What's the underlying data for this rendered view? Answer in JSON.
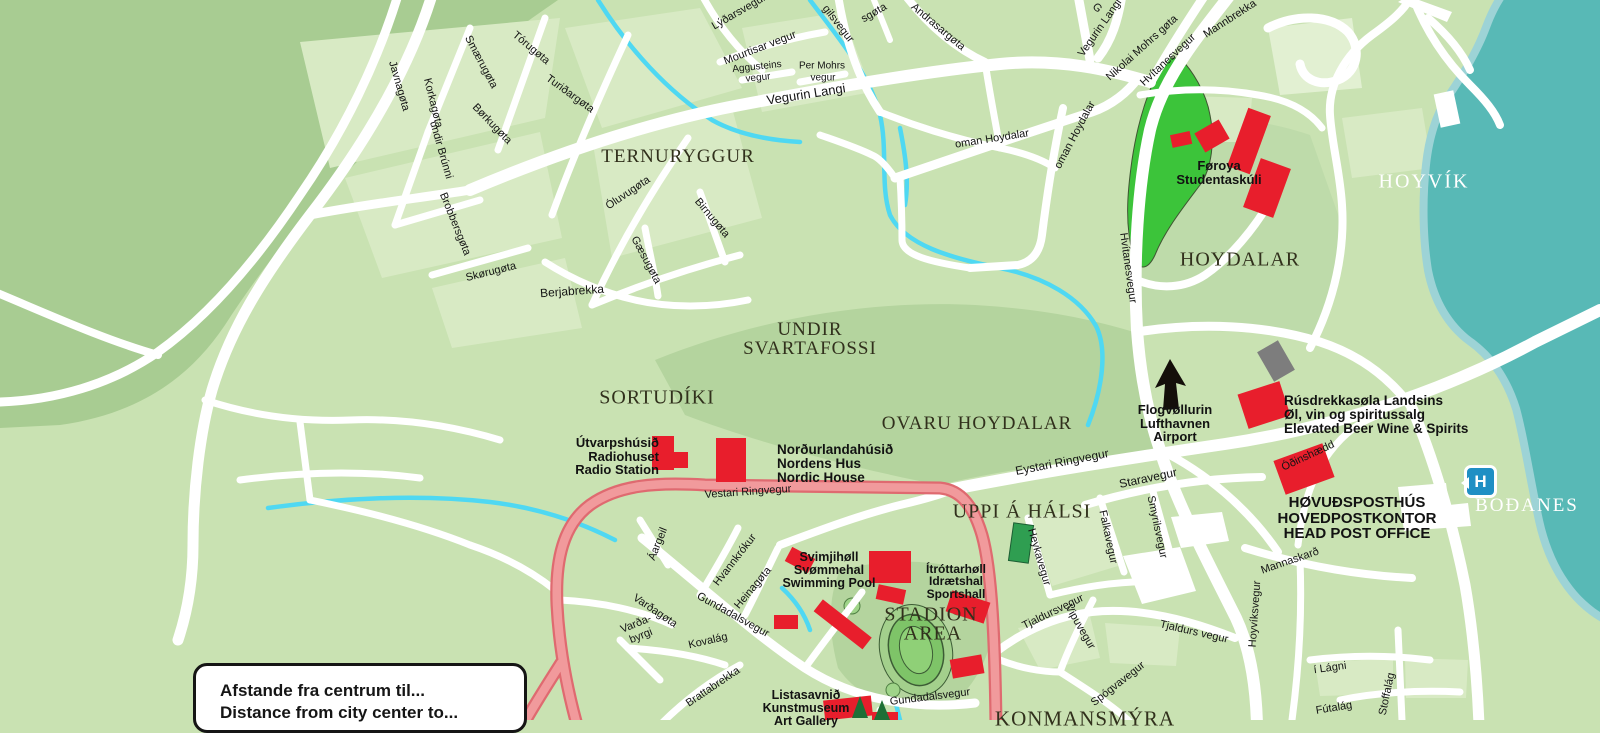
{
  "map": {
    "colors": {
      "land_base": "#c9e2b2",
      "land_light": "#d8eac4",
      "land_lighter": "#e2f0d2",
      "land_dark": "#a8cc92",
      "land_medium": "#b4d49e",
      "land_medium2": "#bedbaa",
      "park": "#3cc43a",
      "park_edge": "#3f5632",
      "water": "#58b9b6",
      "water_fringe": "#9dd3d6",
      "stream": "#4fd8f2",
      "road": "#ffffff",
      "ring_casing": "#df6a70",
      "ring_fill": "#f19a9c",
      "building_red": "#e81e2c",
      "building_gray": "#7d7d7d",
      "building_green": "#2f9e51",
      "track_blob": "#a3d08c",
      "track_green": "#7ec468",
      "track_line": "#3c5c35",
      "tree_dark": "#1e6f36",
      "arrow": "#140f0a",
      "hospital": "#1f8fc4"
    },
    "legend": {
      "line1": "Afstande fra centrum til...",
      "line2": "Distance from city center to..."
    },
    "hospital": {
      "letter": "H"
    },
    "street_labels": [
      {
        "text": "Javnagøta",
        "x": 399,
        "y": 86,
        "r": 74,
        "s": 11
      },
      {
        "text": "Korkagøta",
        "x": 433,
        "y": 103,
        "r": 76,
        "s": 11
      },
      {
        "text": "undir Brúnni",
        "x": 441,
        "y": 150,
        "r": 74,
        "s": 11
      },
      {
        "text": "Smærugøta",
        "x": 481,
        "y": 62,
        "r": 62,
        "s": 11
      },
      {
        "text": "Tórugøta",
        "x": 531,
        "y": 48,
        "r": 40,
        "s": 11
      },
      {
        "text": "Turiðargøta",
        "x": 570,
        "y": 94,
        "r": 36,
        "s": 11
      },
      {
        "text": "Børkugøta",
        "x": 492,
        "y": 124,
        "r": 46,
        "s": 11
      },
      {
        "text": "Brobbersgøta",
        "x": 455,
        "y": 224,
        "r": 68,
        "s": 11
      },
      {
        "text": "Skørugøta",
        "x": 491,
        "y": 272,
        "r": -14,
        "s": 11
      },
      {
        "text": "Berjabrekka",
        "x": 572,
        "y": 291,
        "r": -4,
        "s": 12
      },
      {
        "text": "Óluvugøta",
        "x": 628,
        "y": 193,
        "r": -34,
        "s": 11
      },
      {
        "text": "Gæsugøta",
        "x": 646,
        "y": 260,
        "r": 62,
        "s": 11
      },
      {
        "text": "Birnugøta",
        "x": 712,
        "y": 218,
        "r": 50,
        "s": 11
      },
      {
        "text": "Lýðarsvegur",
        "x": 739,
        "y": 12,
        "r": -30,
        "s": 11
      },
      {
        "text": "Mourtisar vegur",
        "x": 760,
        "y": 48,
        "r": -21,
        "s": 11
      },
      {
        "text": "Aggusteins",
        "x": 757,
        "y": 67,
        "r": -6,
        "s": 10
      },
      {
        "text": "vegur",
        "x": 758,
        "y": 78,
        "r": -6,
        "s": 10
      },
      {
        "text": "Per Mohrs",
        "x": 822,
        "y": 66,
        "r": 0,
        "s": 10
      },
      {
        "text": "vegur",
        "x": 823,
        "y": 78,
        "r": 0,
        "s": 10
      },
      {
        "text": "Vegurin Langi",
        "x": 806,
        "y": 94,
        "r": -9,
        "s": 13
      },
      {
        "text": "gilsvegur",
        "x": 838,
        "y": 24,
        "r": 52,
        "s": 11
      },
      {
        "text": "sgøta",
        "x": 874,
        "y": 13,
        "r": -30,
        "s": 11
      },
      {
        "text": "Andrasargøta",
        "x": 938,
        "y": 27,
        "r": 40,
        "s": 11
      },
      {
        "text": "oman Hoydalar",
        "x": 992,
        "y": 139,
        "r": -9,
        "s": 11
      },
      {
        "text": "oman Hoydalar",
        "x": 1075,
        "y": 135,
        "r": -62,
        "s": 11
      },
      {
        "text": "Vegurin Langi",
        "x": 1100,
        "y": 28,
        "r": -55,
        "s": 11
      },
      {
        "text": "Nikolai Mohrs gøta",
        "x": 1142,
        "y": 48,
        "r": -42,
        "s": 11
      },
      {
        "text": "Mannbrekka",
        "x": 1230,
        "y": 19,
        "r": -33,
        "s": 11
      },
      {
        "text": "G",
        "x": 1097,
        "y": 8,
        "r": 45,
        "s": 11
      },
      {
        "text": "Hvítanesvegur",
        "x": 1168,
        "y": 60,
        "r": -43,
        "s": 11
      },
      {
        "text": "Hvítanesvegur",
        "x": 1128,
        "y": 268,
        "r": 82,
        "s": 11
      },
      {
        "text": "Vestari Ringvegur",
        "x": 748,
        "y": 492,
        "r": -4,
        "s": 11
      },
      {
        "text": "Eystari Ringvegur",
        "x": 1062,
        "y": 462,
        "r": -11,
        "s": 12
      },
      {
        "text": "Staravegur",
        "x": 1148,
        "y": 478,
        "r": -12,
        "s": 12
      },
      {
        "text": "Falkavegur",
        "x": 1108,
        "y": 537,
        "r": 78,
        "s": 11
      },
      {
        "text": "Smyrilsvegur",
        "x": 1157,
        "y": 527,
        "r": 78,
        "s": 11
      },
      {
        "text": "Heykavegur",
        "x": 1039,
        "y": 557,
        "r": 74,
        "s": 11
      },
      {
        "text": "Áargeil",
        "x": 658,
        "y": 544,
        "r": -68,
        "s": 11
      },
      {
        "text": "Hvannkrókur",
        "x": 735,
        "y": 560,
        "r": -52,
        "s": 11
      },
      {
        "text": "Heinagøta",
        "x": 753,
        "y": 588,
        "r": -50,
        "s": 11
      },
      {
        "text": "Gundadalsvegur",
        "x": 733,
        "y": 615,
        "r": 29,
        "s": 11
      },
      {
        "text": "Varðagøta",
        "x": 655,
        "y": 611,
        "r": 34,
        "s": 11
      },
      {
        "text": "Varða-",
        "x": 636,
        "y": 624,
        "r": -22,
        "s": 11
      },
      {
        "text": "byrgi",
        "x": 641,
        "y": 636,
        "r": -22,
        "s": 11
      },
      {
        "text": "Kovalág",
        "x": 708,
        "y": 641,
        "r": -13,
        "s": 11
      },
      {
        "text": "Brattabrekka",
        "x": 713,
        "y": 687,
        "r": -34,
        "s": 11
      },
      {
        "text": "Gundadalsvegur",
        "x": 930,
        "y": 697,
        "r": -7,
        "s": 11
      },
      {
        "text": "Tjaldursvegur",
        "x": 1053,
        "y": 612,
        "r": -26,
        "s": 11
      },
      {
        "text": "Tjaldurs vegur",
        "x": 1194,
        "y": 632,
        "r": 13,
        "s": 11
      },
      {
        "text": "Vipuvegur",
        "x": 1080,
        "y": 627,
        "r": 60,
        "s": 11
      },
      {
        "text": "Spógvavegur",
        "x": 1118,
        "y": 684,
        "r": -38,
        "s": 11
      },
      {
        "text": "Hoyvíksvegur",
        "x": 1255,
        "y": 614,
        "r": -86,
        "s": 11
      },
      {
        "text": "Mannaskarð",
        "x": 1290,
        "y": 561,
        "r": -19,
        "s": 11
      },
      {
        "text": "í Lágni",
        "x": 1330,
        "y": 668,
        "r": -8,
        "s": 11
      },
      {
        "text": "Fútalág",
        "x": 1334,
        "y": 708,
        "r": -9,
        "s": 11
      },
      {
        "text": "Stoffalág",
        "x": 1387,
        "y": 694,
        "r": -78,
        "s": 11
      },
      {
        "text": "Óðinshædd",
        "x": 1308,
        "y": 456,
        "r": -25,
        "s": 11
      }
    ],
    "district_labels": [
      {
        "text": "TERNURYGGUR",
        "x": 678,
        "y": 157,
        "s": 19
      },
      {
        "text": "UNDIR",
        "x": 810,
        "y": 330,
        "s": 19
      },
      {
        "text": "SVARTAFOSSI",
        "x": 810,
        "y": 349,
        "s": 19
      },
      {
        "text": "SORTUDÍKI",
        "x": 657,
        "y": 398,
        "s": 20
      },
      {
        "text": "OVARU HOYDALAR",
        "x": 977,
        "y": 424,
        "s": 19
      },
      {
        "text": "UPPI Á HÁLSI",
        "x": 1022,
        "y": 512,
        "s": 20
      },
      {
        "text": "STADION",
        "x": 931,
        "y": 615,
        "s": 20
      },
      {
        "text": "AREA",
        "x": 933,
        "y": 634,
        "s": 20
      },
      {
        "text": "HOYDALAR",
        "x": 1240,
        "y": 260,
        "s": 20
      },
      {
        "text": "KONMANSMÝRA",
        "x": 1085,
        "y": 719,
        "s": 21
      },
      {
        "text": "HOYVÍK",
        "x": 1424,
        "y": 182,
        "s": 20,
        "style": "coast"
      },
      {
        "text": "BOÐANES",
        "x": 1527,
        "y": 506,
        "s": 19,
        "style": "coast"
      }
    ],
    "poi_labels": [
      {
        "lines": [
          "Føroya",
          "Studentaskúli"
        ],
        "x": 1219,
        "y": 159,
        "s": 13,
        "align": "center"
      },
      {
        "lines": [
          "Flogvøllurin",
          "Lufthavnen",
          "Airport"
        ],
        "x": 1175,
        "y": 403,
        "s": 13,
        "align": "center"
      },
      {
        "lines": [
          "Rúsdrekkasøla Landsins",
          "Øl, vin og spiritussalg",
          "Elevated Beer Wine & Spirits"
        ],
        "x": 1284,
        "y": 394,
        "s": 13.5,
        "align": "left"
      },
      {
        "lines": [
          "HØVUÐSPOSTHÚS",
          "HOVEDPOSTKONTOR",
          "HEAD POST OFFICE"
        ],
        "x": 1357,
        "y": 495,
        "s": 15,
        "align": "center"
      },
      {
        "lines": [
          "Útvarpshúsið",
          "Radiohuset",
          "Radio Station"
        ],
        "x": 659,
        "y": 436,
        "s": 13,
        "align": "right"
      },
      {
        "lines": [
          "Norðurlandahúsið",
          "Nordens Hus",
          "Nordic House"
        ],
        "x": 777,
        "y": 443,
        "s": 13.5,
        "align": "left"
      },
      {
        "lines": [
          "Svimjihøll",
          "Svømmehal",
          "Swimming Pool"
        ],
        "x": 829,
        "y": 551,
        "s": 12.5,
        "align": "center"
      },
      {
        "lines": [
          "Ítróttarhøll",
          "Idrætshal",
          "Sportshall"
        ],
        "x": 956,
        "y": 563,
        "s": 12,
        "align": "center"
      },
      {
        "lines": [
          "Listasavnið",
          "Kunstmuseum",
          "Art Gallery"
        ],
        "x": 806,
        "y": 689,
        "s": 12.5,
        "align": "center"
      }
    ]
  }
}
